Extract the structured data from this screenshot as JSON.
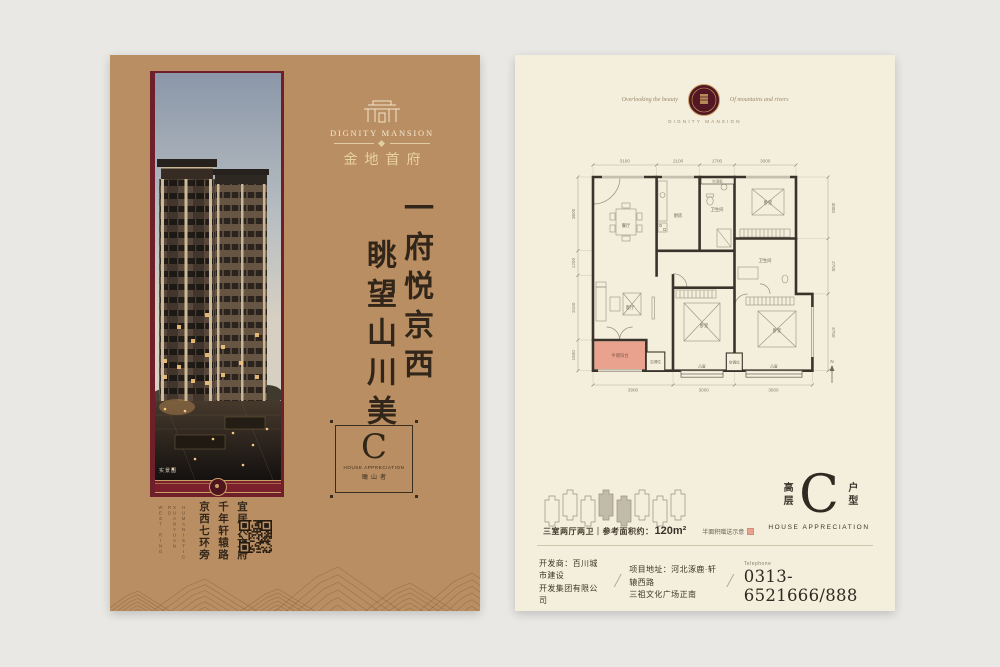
{
  "left_panel": {
    "brand": {
      "name_en": "DIGNITY MANSION",
      "name_cn": "金地首府"
    },
    "slogan": {
      "col_right": "一府悦京西",
      "col_left": "眺望山川美"
    },
    "badge": {
      "letter": "C",
      "subtitle": "HOUSE APPRECIATION",
      "caption": "瞰山者"
    },
    "photo_caption": "实景图",
    "footer": {
      "en_cols": [
        "WEST RING",
        "XUANYUAN RD",
        "HUMANISTIC"
      ],
      "cn_cols": [
        "京西七环旁",
        "千年轩辕路",
        "宜居人文府"
      ]
    }
  },
  "right_panel": {
    "header": {
      "script_left": "Overlooking the beauty",
      "script_right": "Of mountains and rivers",
      "sub": "DIGNITY MANSION"
    },
    "floorplan": {
      "dims_top": [
        "3100",
        "2100",
        "1700",
        "3000"
      ],
      "dims_bottom": [
        "3900",
        "3000",
        "3800"
      ],
      "dims_left": [
        "3600",
        "1200",
        "3150",
        "1500"
      ],
      "dims_right": [
        "3000",
        "2700",
        "3750"
      ],
      "rooms": {
        "dining": "餐厅",
        "living": "客厅",
        "kitchen": "厨房",
        "bath1": "卫生间",
        "bath2": "卫生间",
        "bed1": "卧室",
        "bed2": "卧室",
        "bed3": "卧室",
        "balcony": "半赠阳台",
        "ac_board": "空调板",
        "ac1": "空调位",
        "ac2": "空调位",
        "bay1": "凸窗",
        "bay2": "凸窗"
      },
      "compass": "N"
    },
    "unit_info": {
      "layout": "三室两厅两卫｜参考面积约：",
      "area": "120m²",
      "legend": "半面积赠送示意"
    },
    "type_block": {
      "prefix": "高层",
      "letter": "C",
      "suffix": "户型",
      "subtitle": "HOUSE APPRECIATION"
    },
    "developer": {
      "dev1": "开发商：百川城市建设",
      "dev2": "开发集团有限公司",
      "addr1": "项目地址：河北涿鹿·轩辕西路",
      "addr2": "三祖文化广场正南",
      "tel_label": "Telephone",
      "tel": "0313-6521666/888",
      "slash": "/"
    }
  }
}
